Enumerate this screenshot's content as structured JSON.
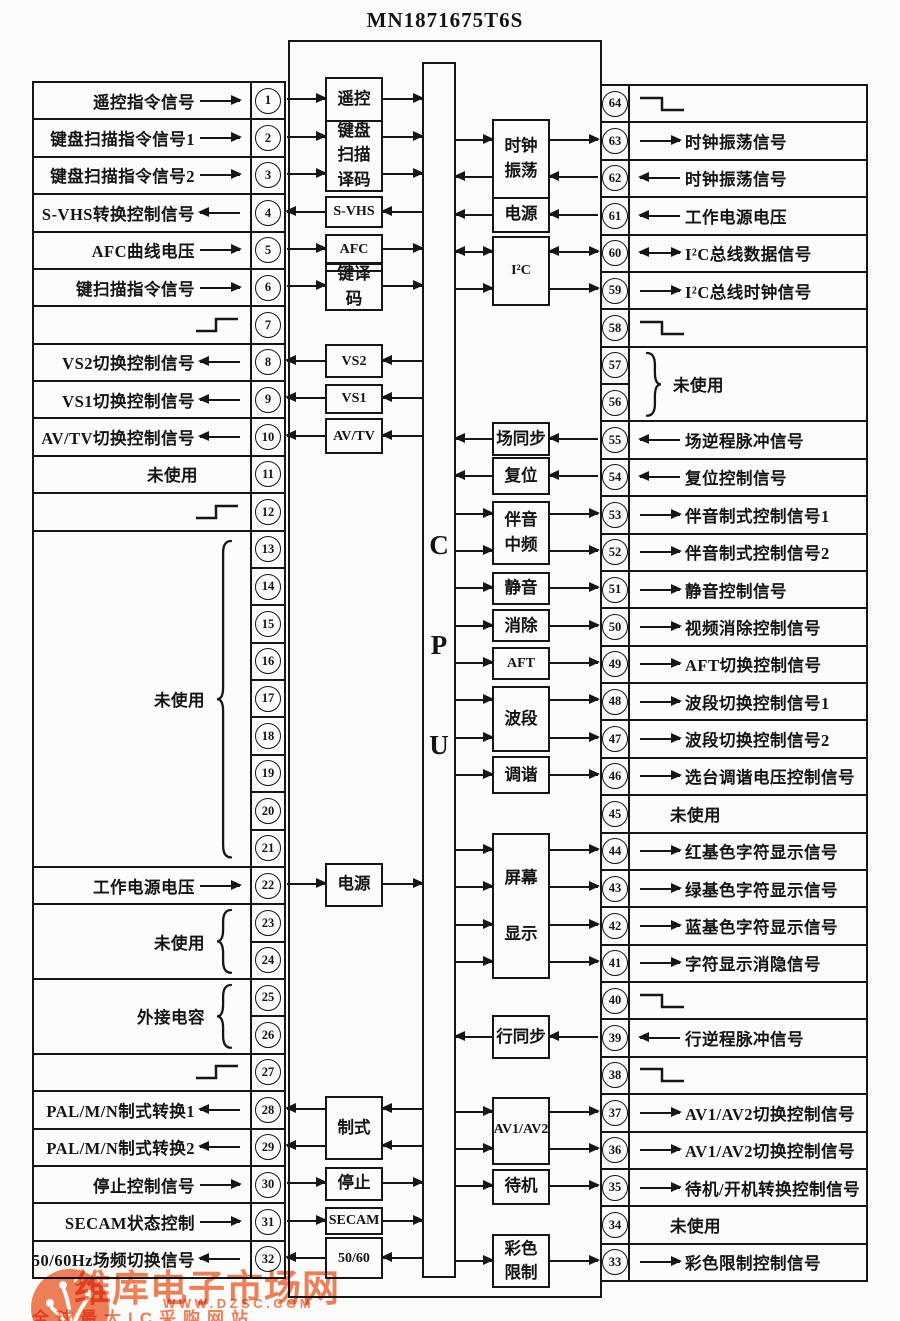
{
  "title": "MN1871675T6S",
  "cpu_letters": [
    "C",
    "P",
    "U"
  ],
  "watermark": {
    "brand": "维库电子市场网",
    "url": "WWW.DZSC.COM",
    "slogan": "全球最大IC采购网站",
    "color": "#ee6a3c"
  },
  "left_cells": [
    {
      "pin": "1",
      "label": "遥控指令信号",
      "dir": "in"
    },
    {
      "pin": "2",
      "label": "键盘扫描指令信号1",
      "dir": "in"
    },
    {
      "pin": "3",
      "label": "键盘扫描指令信号2",
      "dir": "in"
    },
    {
      "pin": "4",
      "label": "S-VHS转换控制信号",
      "dir": "out"
    },
    {
      "pin": "5",
      "label": "AFC曲线电压",
      "dir": "in"
    },
    {
      "pin": "6",
      "label": "键扫描指令信号",
      "dir": "in"
    },
    {
      "pin": "7",
      "symbol": "pulse"
    },
    {
      "pin": "8",
      "label": "VS2切换控制信号",
      "dir": "out"
    },
    {
      "pin": "9",
      "label": "VS1切换控制信号",
      "dir": "out"
    },
    {
      "pin": "10",
      "label": "AV/TV切换控制信号",
      "dir": "out"
    },
    {
      "pin": "11",
      "label": "未使用",
      "dir": "none"
    },
    {
      "pin": "12",
      "symbol": "pulse"
    },
    {
      "pins": [
        "13",
        "14",
        "15",
        "16",
        "17",
        "18",
        "19",
        "20",
        "21"
      ],
      "label": "未使用",
      "brace": true
    },
    {
      "pin": "22",
      "label": "工作电源电压",
      "dir": "in"
    },
    {
      "pins": [
        "23",
        "24"
      ],
      "label": "未使用",
      "brace": true
    },
    {
      "pins": [
        "25",
        "26"
      ],
      "label": "外接电容",
      "brace": true
    },
    {
      "pin": "27",
      "symbol": "pulse"
    },
    {
      "pin": "28",
      "label": "PAL/M/N制式转换1",
      "dir": "out"
    },
    {
      "pin": "29",
      "label": "PAL/M/N制式转换2",
      "dir": "out"
    },
    {
      "pin": "30",
      "label": "停止控制信号",
      "dir": "in"
    },
    {
      "pin": "31",
      "label": "SECAM状态控制",
      "dir": "in"
    },
    {
      "pin": "32",
      "label": "50/60Hz场频切换信号",
      "dir": "out"
    }
  ],
  "right_cells": [
    {
      "pin": "64",
      "symbol": "pulse"
    },
    {
      "pin": "63",
      "label": "时钟振荡信号",
      "dir": "out"
    },
    {
      "pin": "62",
      "label": "时钟振荡信号",
      "dir": "in"
    },
    {
      "pin": "61",
      "label": "工作电源电压",
      "dir": "in"
    },
    {
      "pin": "60",
      "label": "I²C总线数据信号",
      "dir": "bi"
    },
    {
      "pin": "59",
      "label": "I²C总线时钟信号",
      "dir": "out"
    },
    {
      "pin": "58",
      "symbol": "pulse"
    },
    {
      "pins": [
        "57",
        "56"
      ],
      "label": "未使用",
      "brace": true
    },
    {
      "pin": "55",
      "label": "场逆程脉冲信号",
      "dir": "in"
    },
    {
      "pin": "54",
      "label": "复位控制信号",
      "dir": "in"
    },
    {
      "pin": "53",
      "label": "伴音制式控制信号1",
      "dir": "out"
    },
    {
      "pin": "52",
      "label": "伴音制式控制信号2",
      "dir": "out"
    },
    {
      "pin": "51",
      "label": "静音控制信号",
      "dir": "out"
    },
    {
      "pin": "50",
      "label": "视频消除控制信号",
      "dir": "out"
    },
    {
      "pin": "49",
      "label": "AFT切换控制信号",
      "dir": "out"
    },
    {
      "pin": "48",
      "label": "波段切换控制信号1",
      "dir": "out"
    },
    {
      "pin": "47",
      "label": "波段切换控制信号2",
      "dir": "out"
    },
    {
      "pin": "46",
      "label": "选台调谐电压控制信号",
      "dir": "out"
    },
    {
      "pin": "45",
      "label": "未使用",
      "dir": "none"
    },
    {
      "pin": "44",
      "label": "红基色字符显示信号",
      "dir": "out"
    },
    {
      "pin": "43",
      "label": "绿基色字符显示信号",
      "dir": "out"
    },
    {
      "pin": "42",
      "label": "蓝基色字符显示信号",
      "dir": "out"
    },
    {
      "pin": "41",
      "label": "字符显示消隐信号",
      "dir": "out"
    },
    {
      "pin": "40",
      "symbol": "pulse"
    },
    {
      "pin": "39",
      "label": "行逆程脉冲信号",
      "dir": "in"
    },
    {
      "pin": "38",
      "symbol": "pulse"
    },
    {
      "pin": "37",
      "label": "AV1/AV2切换控制信号",
      "dir": "out"
    },
    {
      "pin": "36",
      "label": "AV1/AV2切换控制信号",
      "dir": "out"
    },
    {
      "pin": "35",
      "label": "待机/开机转换控制信号",
      "dir": "out"
    },
    {
      "pin": "34",
      "label": "未使用",
      "dir": "none"
    },
    {
      "pin": "33",
      "label": "彩色限制控制信号",
      "dir": "out"
    }
  ],
  "left_blocks": [
    {
      "label": "遥控",
      "dirs": [
        "in"
      ]
    },
    {
      "label": "键盘\n扫描\n译码",
      "dirs": [
        "in",
        "in"
      ]
    },
    {
      "label": "S-VHS",
      "dirs": [
        "out"
      ]
    },
    {
      "label": "AFC",
      "dirs": [
        "in"
      ]
    },
    {
      "label": "键译\n码",
      "dirs": [
        "in"
      ]
    },
    {
      "label": "VS2",
      "dirs": [
        "out"
      ]
    },
    {
      "label": "VS1",
      "dirs": [
        "out"
      ]
    },
    {
      "label": "AV/TV",
      "dirs": [
        "out"
      ]
    },
    {
      "label": "电源",
      "dirs": [
        "in"
      ]
    },
    {
      "label": "制式",
      "dirs": [
        "out",
        "out"
      ]
    },
    {
      "label": "停止",
      "dirs": [
        "in"
      ]
    },
    {
      "label": "SECAM",
      "dirs": [
        "in"
      ]
    },
    {
      "label": "50/60",
      "dirs": [
        "out"
      ]
    }
  ],
  "right_blocks": [
    {
      "label": "时钟\n振荡",
      "dirs": [
        "out",
        "in"
      ]
    },
    {
      "label": "电源",
      "dirs": [
        "in"
      ]
    },
    {
      "label": "I²C",
      "dirs": [
        "bi",
        "out"
      ]
    },
    {
      "label": "场同步",
      "dirs": [
        "in"
      ]
    },
    {
      "label": "复位",
      "dirs": [
        "in"
      ]
    },
    {
      "label": "伴音\n中频",
      "dirs": [
        "out",
        "out"
      ]
    },
    {
      "label": "静音",
      "dirs": [
        "out"
      ]
    },
    {
      "label": "消除",
      "dirs": [
        "out"
      ]
    },
    {
      "label": "AFT",
      "dirs": [
        "out"
      ]
    },
    {
      "label": "波段",
      "dirs": [
        "out",
        "out"
      ]
    },
    {
      "label": "调谐",
      "dirs": [
        "out"
      ]
    },
    {
      "label": "屏幕\n显示",
      "dirs": [
        "out",
        "out",
        "out",
        "out"
      ]
    },
    {
      "label": "行同步",
      "dirs": [
        "in"
      ]
    },
    {
      "label": "AV1/AV2",
      "dirs": [
        "out",
        "out"
      ]
    },
    {
      "label": "待机",
      "dirs": [
        "out"
      ]
    },
    {
      "label": "彩色\n限制",
      "dirs": [
        "out",
        "out"
      ]
    }
  ]
}
